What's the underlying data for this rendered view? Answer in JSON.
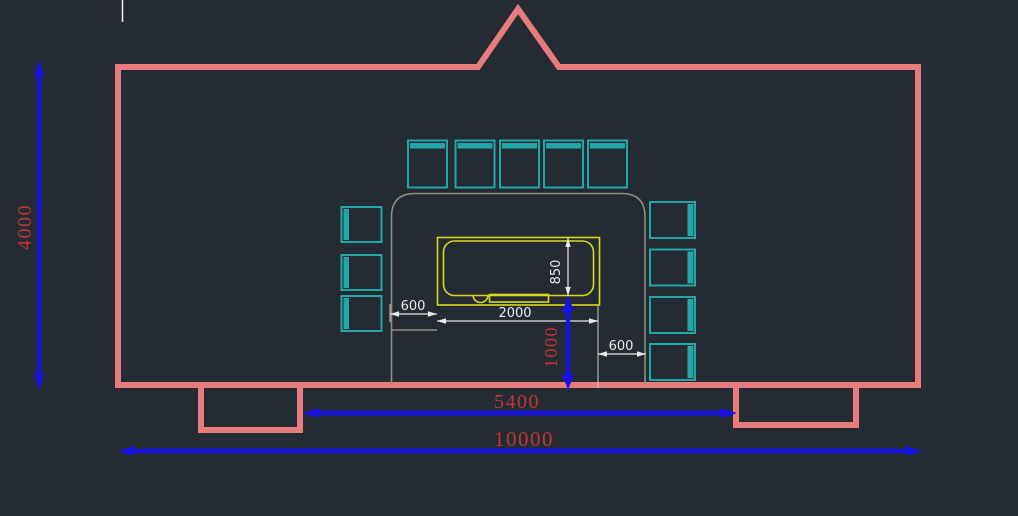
{
  "canvas": {
    "background": "#242b32"
  },
  "palette": {
    "canvas_bg": "#242b32",
    "wall": "#e87c7c",
    "chair": "#22a7a7",
    "table": "#d9d91f",
    "counter": "#8d9184",
    "dim_line_blue": "#1612e6",
    "dim_text_red": "#c13535",
    "dim_white": "#e9e9e9"
  },
  "dimensions": {
    "room_height": "4000",
    "room_width": "10000",
    "front_span": "5400",
    "table_to_front_wall": "1000",
    "left_clearance": "600",
    "table_length": "2000",
    "table_depth": "850",
    "right_clearance": "600"
  },
  "furniture": {
    "top_chair_count": 5,
    "left_chair_count": 3,
    "right_chair_count": 4
  }
}
